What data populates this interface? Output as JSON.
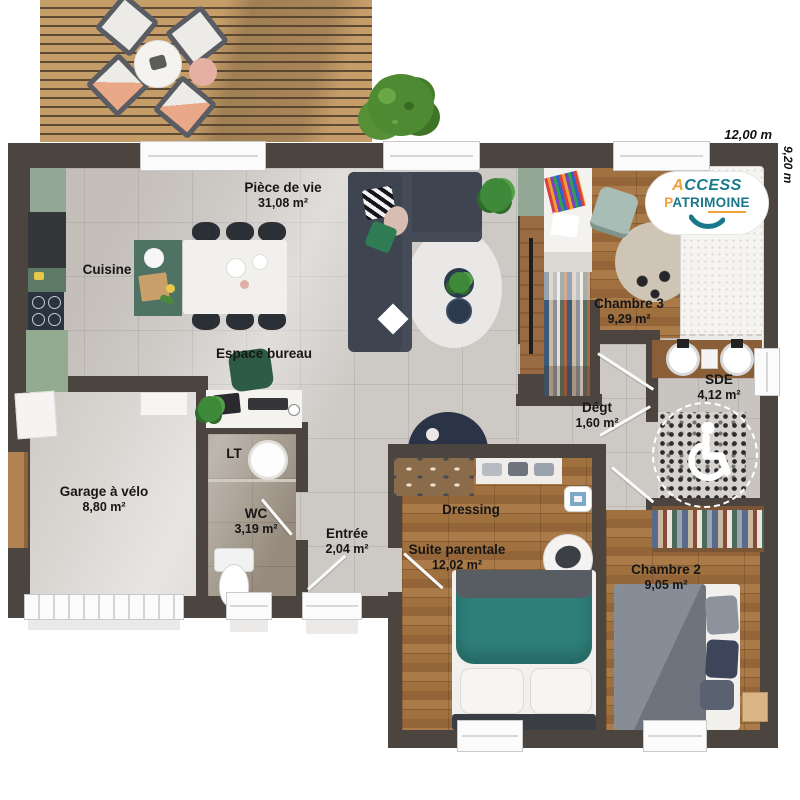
{
  "plan": {
    "dimensions": {
      "width_label": "12,00 m",
      "height_label": "9,20 m"
    },
    "logo": {
      "word1": "ACCESS",
      "word2": "PATRIMOINE"
    },
    "rooms": [
      {
        "name": "Pièce de vie",
        "area": "31,08 m²"
      },
      {
        "name": "Cuisine",
        "area": ""
      },
      {
        "name": "Espace bureau",
        "area": ""
      },
      {
        "name": "Garage à vélo",
        "area": "8,80 m²"
      },
      {
        "name": "LT",
        "area": ""
      },
      {
        "name": "WC",
        "area": "3,19 m²"
      },
      {
        "name": "Entrée",
        "area": "2,04 m²"
      },
      {
        "name": "Dressing",
        "area": ""
      },
      {
        "name": "Suite parentale",
        "area": "12,02 m²"
      },
      {
        "name": "Chambre 2",
        "area": "9,05 m²"
      },
      {
        "name": "Chambre 3",
        "area": "9,29 m²"
      },
      {
        "name": "Dégt",
        "area": "1,60 m²"
      },
      {
        "name": "SDE",
        "area": "4,12 m²"
      }
    ],
    "colors": {
      "wall": "#4b443f",
      "tile": "#cdc9c5",
      "wood": "#9a6b42",
      "logo_teal": "#17798b",
      "logo_orange": "#f0a23a",
      "bed_teal": "#2e7e7a"
    }
  }
}
